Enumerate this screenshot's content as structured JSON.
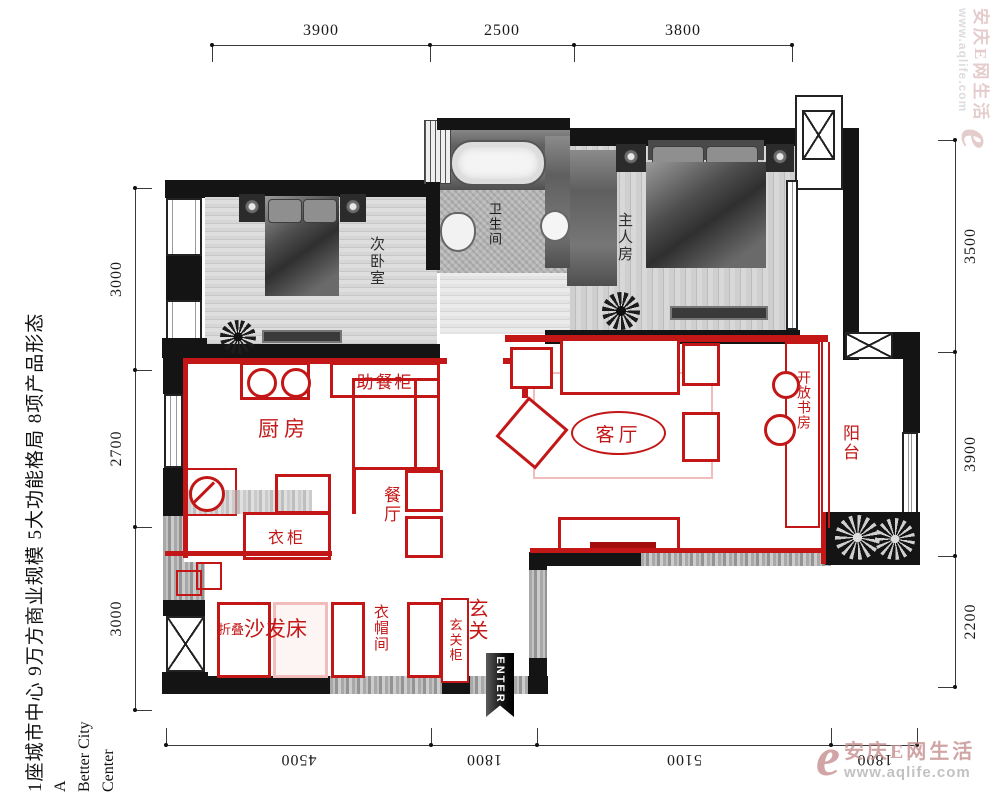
{
  "dimensions": {
    "top": [
      "3900",
      "2500",
      "3800"
    ],
    "bottom": [
      "4500",
      "1800",
      "5100",
      "1800"
    ],
    "left": [
      "3000",
      "2700",
      "3000"
    ],
    "right": [
      "3500",
      "3900",
      "2200"
    ]
  },
  "side_text": {
    "slogan": "1座城市中心 9万方商业规模 5大功能格局 8项产品形态",
    "english_line1": "A",
    "english_line2": "Better City",
    "english_line3": "Center"
  },
  "rooms": {
    "secondary_bedroom": "次卧室",
    "bathroom": "卫生间",
    "master_bedroom": "主人房",
    "kitchen": "厨房",
    "serving_cabinet": "助餐柜",
    "living_room": "客厅",
    "dining_room": "餐厅",
    "wardrobe": "衣柜",
    "open_study": "开放书房",
    "balcony": "阳台",
    "folding": "折叠",
    "sofa_bed": "沙发床",
    "cloakroom": "衣帽间",
    "entry_cabinet": "玄关柜",
    "entry": "玄关"
  },
  "entrance": {
    "label": "ENTER"
  },
  "watermark": {
    "logo": "e",
    "brand": "安庆E网生活",
    "url": "www.aqlife.com"
  },
  "colors": {
    "red": "#c31717",
    "pink": "#f0bcbc",
    "wall": "#141414",
    "rose": "#c68f8f",
    "darkred": "#a50d0d"
  }
}
